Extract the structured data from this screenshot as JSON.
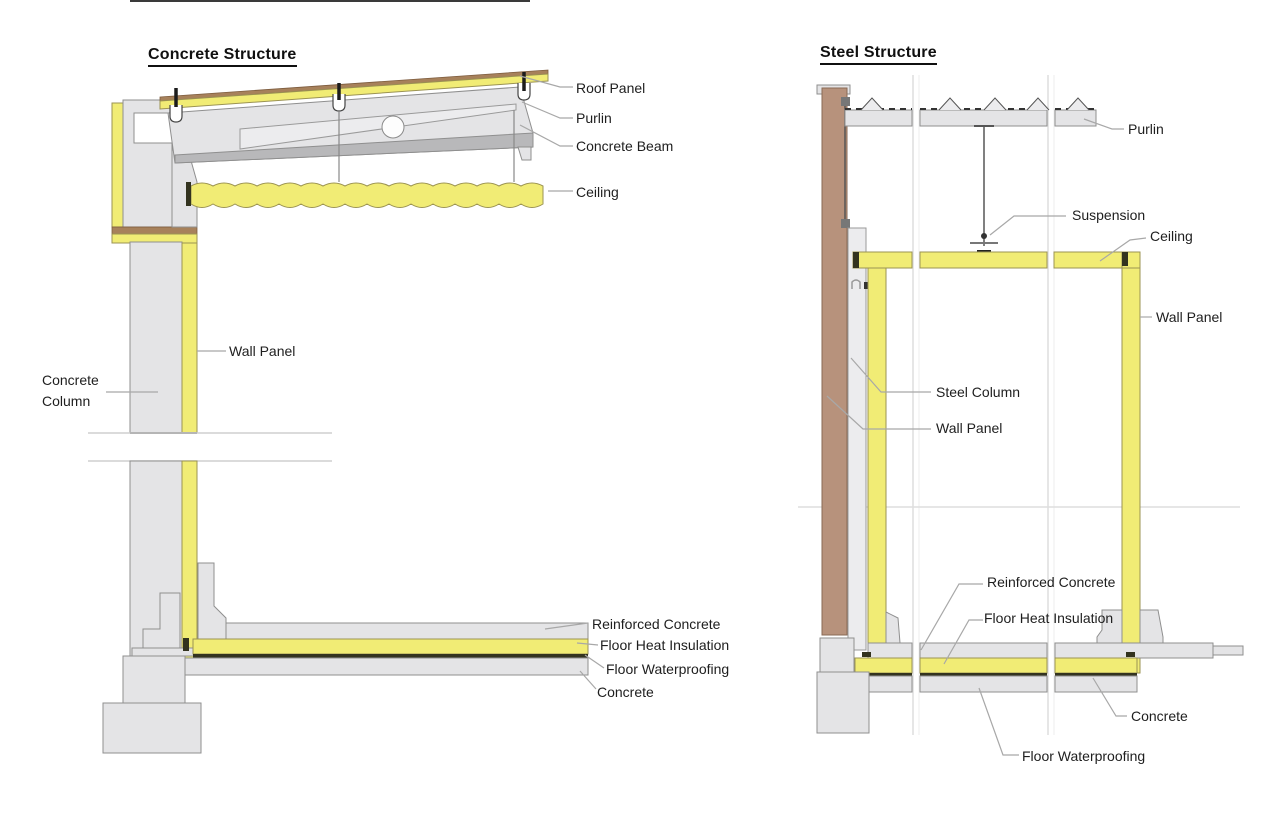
{
  "page": {
    "background": "#ffffff"
  },
  "concrete": {
    "title": "Concrete Structure",
    "labels": {
      "roof_panel": "Roof Panel",
      "purlin": "Purlin",
      "concrete_beam": "Concrete Beam",
      "ceiling": "Ceiling",
      "wall_panel": "Wall Panel",
      "concrete_column": "Concrete Column",
      "reinforced_concrete": "Reinforced Concrete",
      "floor_heat_insulation": "Floor Heat Insulation",
      "floor_waterproofing": "Floor Waterproofing",
      "concrete": "Concrete"
    }
  },
  "steel": {
    "title": "Steel Structure",
    "labels": {
      "purlin": "Purlin",
      "suspension": "Suspension",
      "ceiling": "Ceiling",
      "wall_panel_right": "Wall Panel",
      "steel_column": "Steel Column",
      "wall_panel_left": "Wall Panel",
      "reinforced_concrete": "Reinforced Concrete",
      "floor_heat_insulation": "Floor Heat Insulation",
      "concrete": "Concrete",
      "floor_waterproofing": "Floor Waterproofing"
    }
  },
  "colors": {
    "panel_yellow": "#f1ec75",
    "concrete_gray": "#e4e4e6",
    "steel_wall_brown": "#b7927c",
    "flashing_brown": "#a7815b",
    "waterproofing_dark": "#33331f",
    "leader_gray": "#a8a8a8",
    "grid_gray": "#dedede"
  }
}
